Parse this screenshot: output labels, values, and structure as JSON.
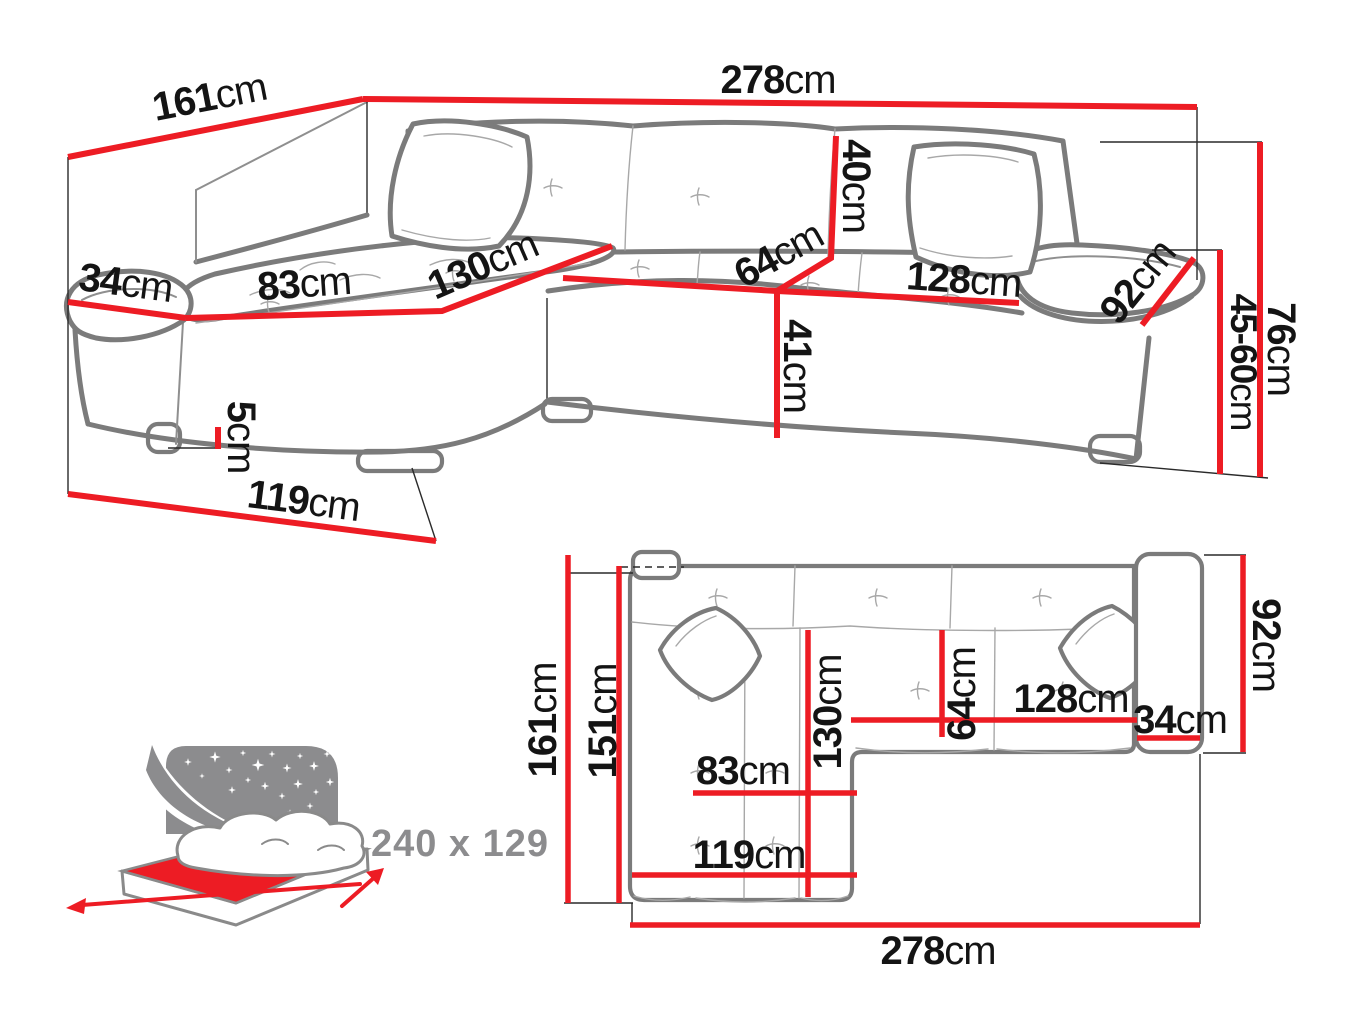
{
  "title": "Corner sofa technical dimension diagram",
  "colors": {
    "dimension_red": "#ed1c24",
    "sofa_outline_grey": "#7b7b7b",
    "text_black": "#141414",
    "icon_grey": "#8c8c8e"
  },
  "perspective": {
    "labels": {
      "total_width": {
        "value": "278",
        "unit": "cm"
      },
      "total_depth": {
        "value": "161",
        "unit": "cm"
      },
      "armrest_left_width": {
        "value": "34",
        "unit": "cm"
      },
      "chaise_seat_width": {
        "value": "83",
        "unit": "cm"
      },
      "chaise_seat_length": {
        "value": "130",
        "unit": "cm"
      },
      "seat_depth": {
        "value": "64",
        "unit": "cm"
      },
      "backrest_height": {
        "value": "40",
        "unit": "cm"
      },
      "seat_width": {
        "value": "128",
        "unit": "cm"
      },
      "armrest_right_len": {
        "value": "92",
        "unit": "cm"
      },
      "total_height": {
        "value": "76",
        "unit": "cm"
      },
      "height_range": {
        "value": "45-60",
        "unit": "cm"
      },
      "seat_height": {
        "value": "41",
        "unit": "cm"
      },
      "leg_height": {
        "value": "5",
        "unit": "cm"
      },
      "chaise_front_width": {
        "value": "119",
        "unit": "cm"
      }
    }
  },
  "plan": {
    "labels": {
      "depth_total": {
        "value": "161",
        "unit": "cm"
      },
      "depth_inner": {
        "value": "151",
        "unit": "cm"
      },
      "chaise_length": {
        "value": "130",
        "unit": "cm"
      },
      "seat_depth": {
        "value": "64",
        "unit": "cm"
      },
      "seat_width": {
        "value": "128",
        "unit": "cm"
      },
      "armrest_width": {
        "value": "34",
        "unit": "cm"
      },
      "side_depth": {
        "value": "92",
        "unit": "cm"
      },
      "chaise_width": {
        "value": "83",
        "unit": "cm"
      },
      "chaise_outer": {
        "value": "119",
        "unit": "cm"
      },
      "width_total": {
        "value": "278",
        "unit": "cm"
      }
    }
  },
  "sleeping_function": {
    "bed_size": "240 x 129"
  }
}
